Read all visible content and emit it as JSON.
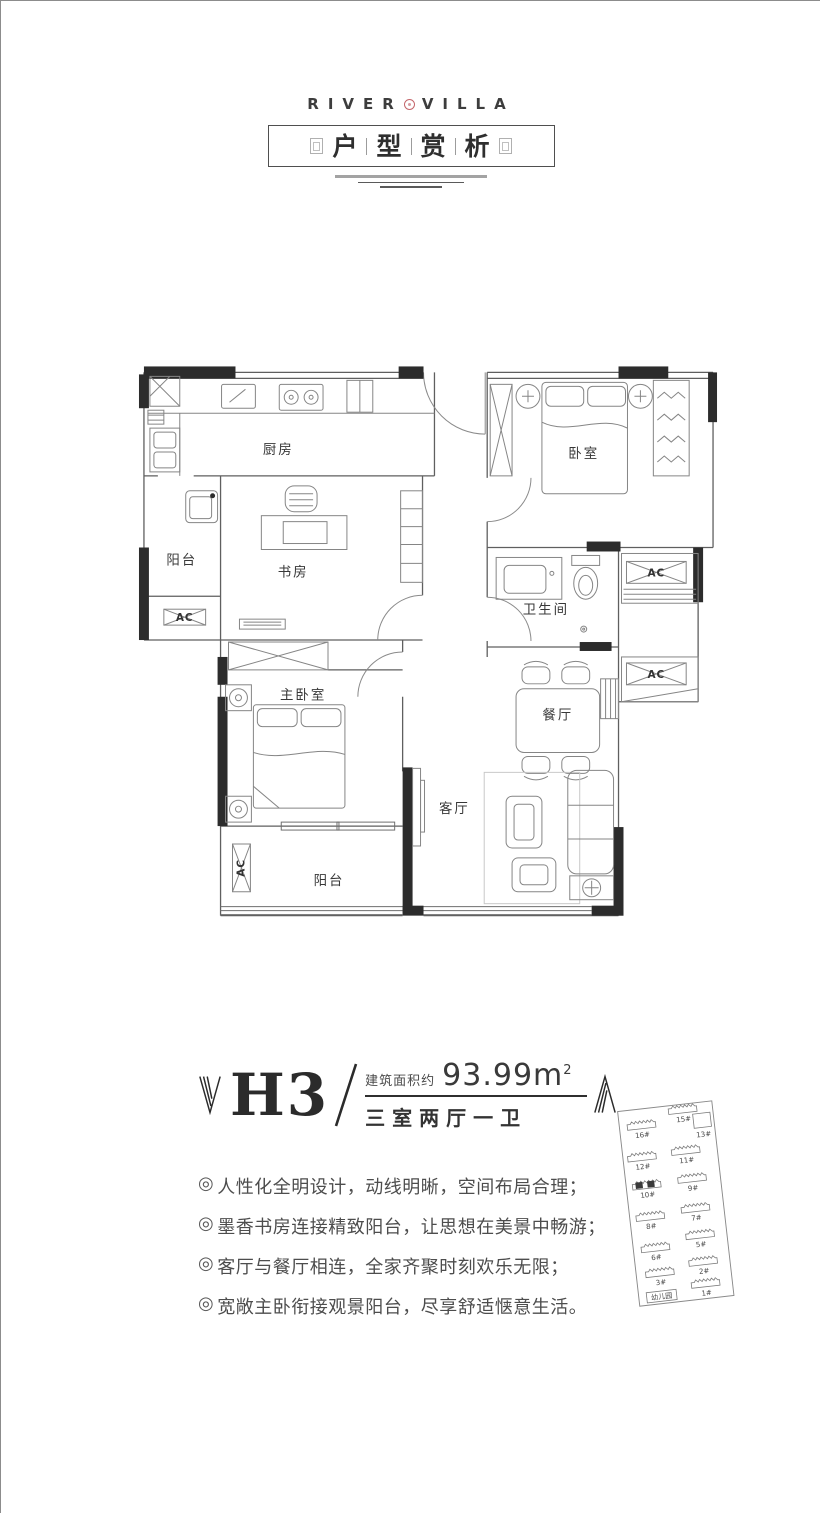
{
  "header": {
    "brand_left": "RIVER",
    "brand_right": "VILLA",
    "title_chars": [
      "户",
      "型",
      "赏",
      "析"
    ],
    "seal_color": "#c4666b"
  },
  "floorplan": {
    "ac_label": "AC",
    "rooms": [
      {
        "id": "kitchen",
        "label": "厨房"
      },
      {
        "id": "balcony-upper",
        "label": "阳台"
      },
      {
        "id": "study",
        "label": "书房"
      },
      {
        "id": "bedroom",
        "label": "卧室"
      },
      {
        "id": "bathroom",
        "label": "卫生间"
      },
      {
        "id": "master-bedroom",
        "label": "主卧室"
      },
      {
        "id": "dining",
        "label": "餐厅"
      },
      {
        "id": "living",
        "label": "客厅"
      },
      {
        "id": "balcony-lower",
        "label": "阳台"
      }
    ]
  },
  "unit": {
    "name": "H3",
    "area_prefix": "建筑面积约",
    "area_value": "93.99m",
    "area_sup": "2",
    "layout": "三室两厅一卫"
  },
  "features": {
    "items": [
      {
        "marker": "◎",
        "text": "人性化全明设计，动线明晰，空间布局合理；"
      },
      {
        "marker": "◎",
        "text": "墨香书房连接精致阳台，让思想在美景中畅游；"
      },
      {
        "marker": "◎",
        "text": "客厅与餐厅相连，全家齐聚时刻欢乐无限；"
      },
      {
        "marker": "◎",
        "text": "宽敞主卧衔接观景阳台，尽享舒适惬意生活。"
      }
    ]
  },
  "sitemap": {
    "highlight_color": "#3a3a3a",
    "buildings": [
      {
        "label": "16#"
      },
      {
        "label": "15#"
      },
      {
        "label": "13#"
      },
      {
        "label": "12#"
      },
      {
        "label": "11#"
      },
      {
        "label": "10#",
        "highlighted": true
      },
      {
        "label": "9#"
      },
      {
        "label": "8#"
      },
      {
        "label": "7#"
      },
      {
        "label": "6#"
      },
      {
        "label": "5#"
      },
      {
        "label": "3#"
      },
      {
        "label": "2#"
      },
      {
        "label": "幼儿园"
      },
      {
        "label": "1#"
      }
    ]
  }
}
